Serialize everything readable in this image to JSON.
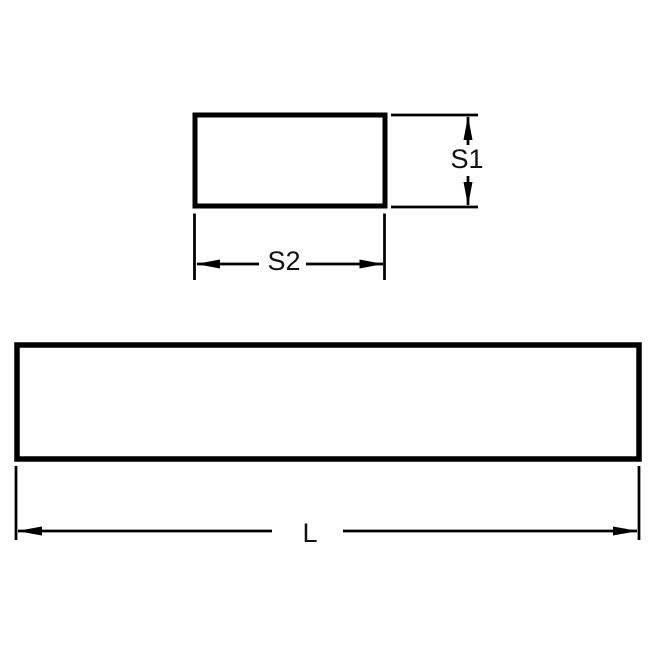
{
  "diagram": {
    "kind": "engineering-dimension-drawing",
    "subject": "Rectangular key stock bar with cross-section and length views",
    "colors": {
      "line": "#000000",
      "label_text": "#111111",
      "background": "#ffffff"
    },
    "views": [
      {
        "id": "cross-section",
        "shape": "rectangle",
        "dimensions": [
          {
            "axis": "vertical",
            "label": "S1"
          },
          {
            "axis": "horizontal",
            "label": "S2"
          }
        ]
      },
      {
        "id": "side-view",
        "shape": "rectangle",
        "dimensions": [
          {
            "axis": "horizontal",
            "label": "L"
          }
        ]
      }
    ],
    "labels": {
      "s1": "S1",
      "s2": "S2",
      "l": "L"
    }
  }
}
